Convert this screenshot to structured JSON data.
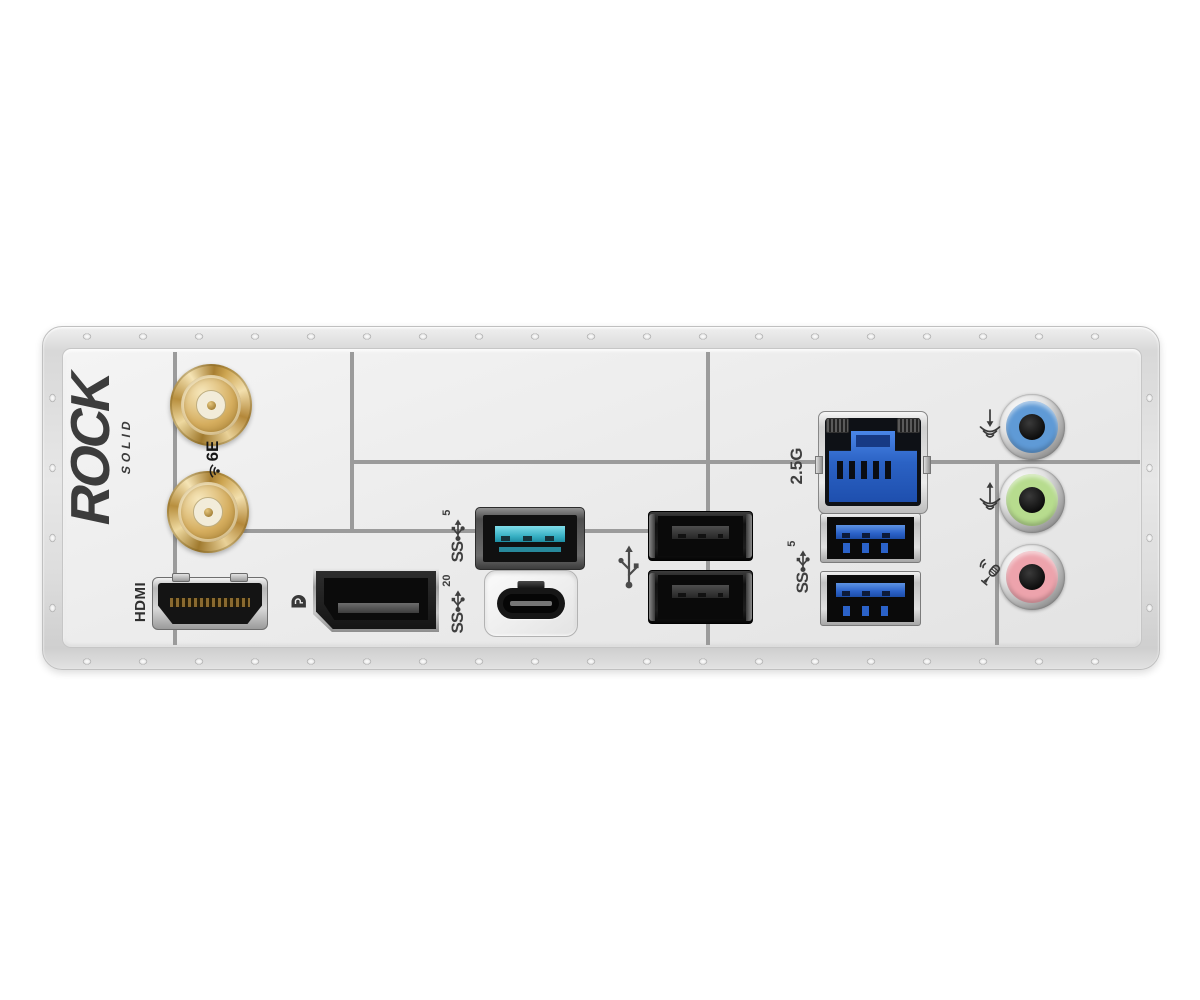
{
  "branding": {
    "primary": "ROCK",
    "secondary": "SOLID"
  },
  "labels": {
    "hdmi": "HDMI",
    "lan_speed": "2.5G",
    "ss_prefix": "SS",
    "usb_gen1_speed": "5",
    "usb_gen2x2_speed": "20",
    "wifi_gen": "6E"
  },
  "ports": [
    {
      "name": "wifi-antenna-upper",
      "type": "SMA antenna connector",
      "color": "#d5ad5e"
    },
    {
      "name": "wifi-antenna-lower",
      "type": "SMA antenna connector",
      "color": "#d5ad5e"
    },
    {
      "name": "hdmi-port",
      "label": "HDMI"
    },
    {
      "name": "displayport-port",
      "label": "DP"
    },
    {
      "name": "usb-a-5gbps-port",
      "label": "SS5",
      "tongue_color": "#36afc3"
    },
    {
      "name": "usb-c-20gbps-port",
      "label": "SS20"
    },
    {
      "name": "usb-2.0-port-top",
      "color": "#1d1d1d"
    },
    {
      "name": "usb-2.0-port-bottom",
      "color": "#1d1d1d"
    },
    {
      "name": "ethernet-rj45-port",
      "label": "2.5G",
      "insert_color": "#2b62c4"
    },
    {
      "name": "usb-3-5gbps-port-top",
      "label": "SS5",
      "tongue_color": "#2b62c8"
    },
    {
      "name": "usb-3-5gbps-port-bottom",
      "label": "SS5",
      "tongue_color": "#2b62c8"
    },
    {
      "name": "audio-line-in-jack",
      "color": "#5f9ad6"
    },
    {
      "name": "audio-line-out-jack",
      "color": "#b7dc8e"
    },
    {
      "name": "audio-mic-jack",
      "color": "#eda3ac"
    }
  ],
  "colors": {
    "shield_frame": "#dedede",
    "face_plate": "#ececec",
    "divider_line": "#9b9b9b",
    "label_text": "#3f3f3f",
    "antenna_gold": "#d5ad5e",
    "usb_gen1_teal": "#36afc3",
    "usb3_blue": "#2b62c8",
    "lan_blue": "#2b62c4",
    "audio_blue": "#5f9ad6",
    "audio_green": "#b7dc8e",
    "audio_pink": "#eda3ac"
  }
}
